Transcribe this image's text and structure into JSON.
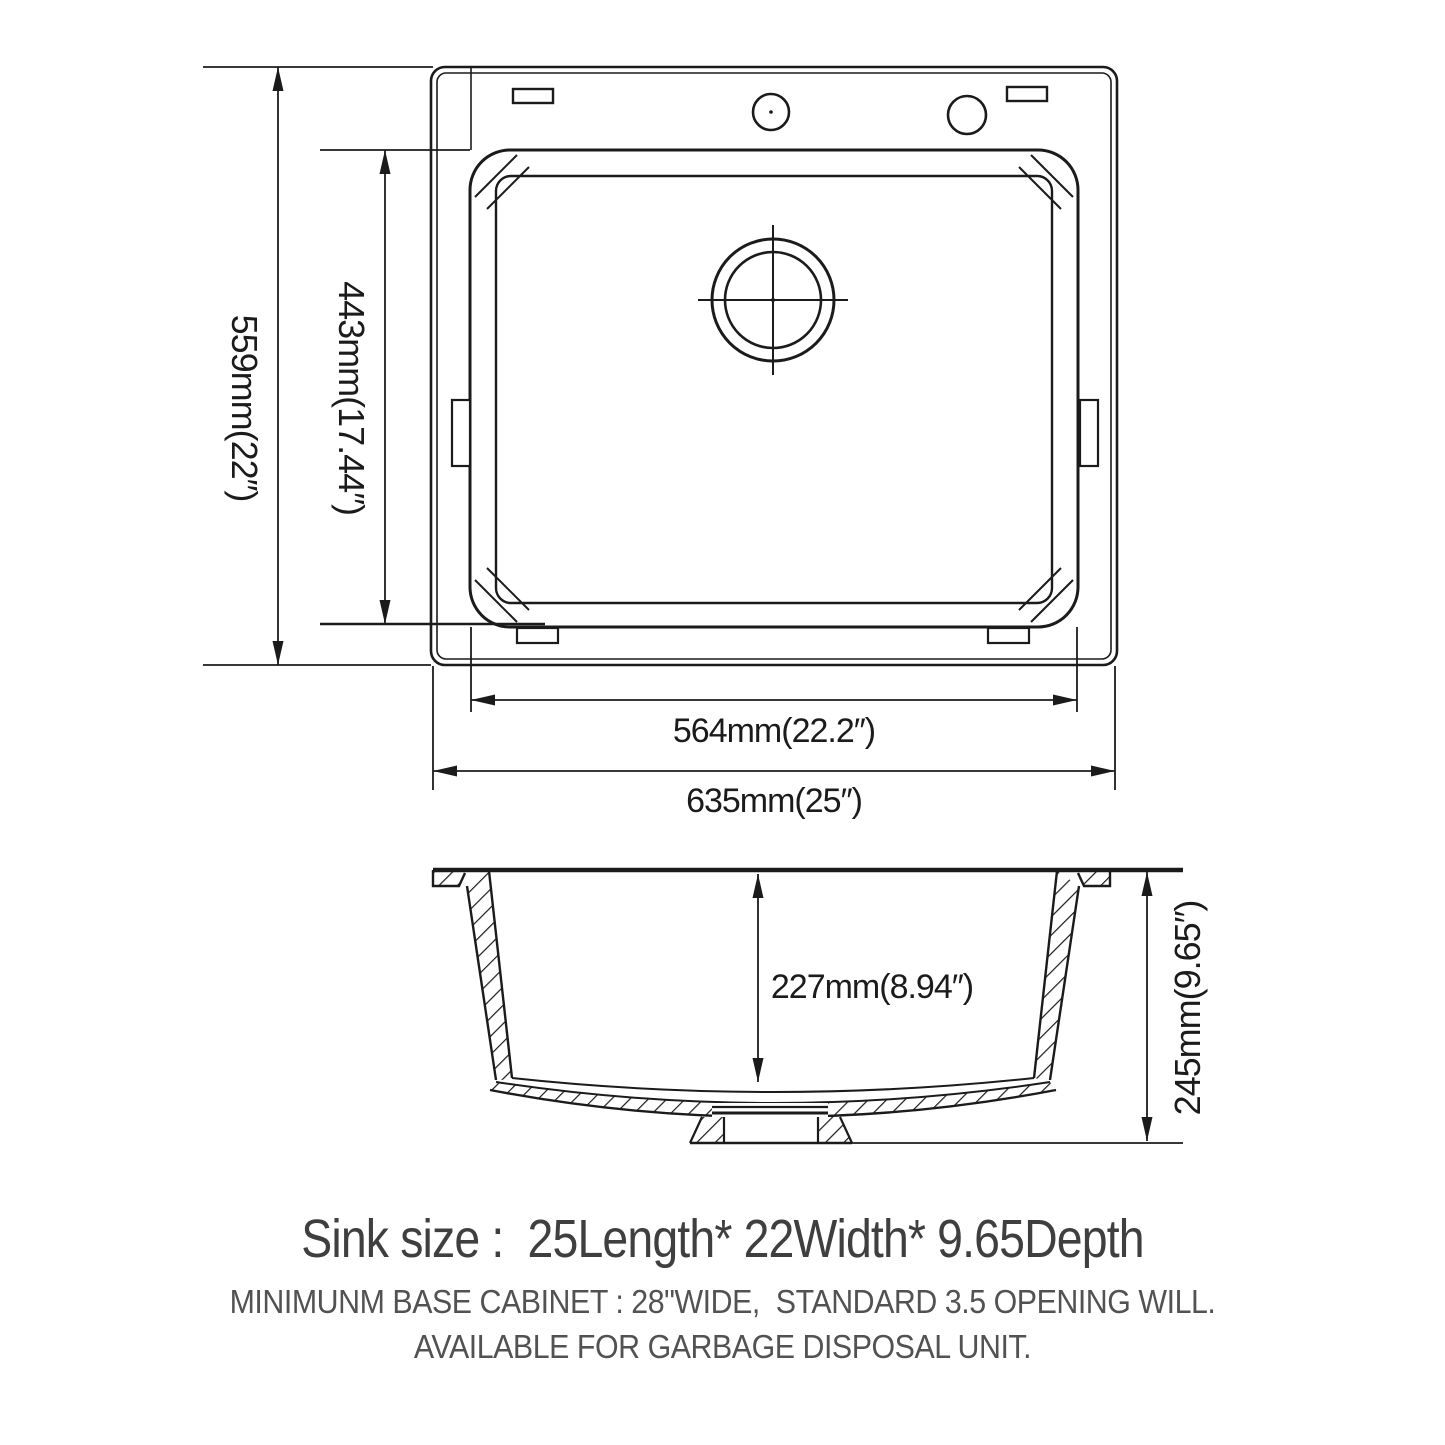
{
  "drawing": {
    "top_view": {
      "dim_overall_width_label": "559mm(22″)",
      "dim_bowl_width_label": "443mm(17.44″)",
      "dim_bowl_length_label": "564mm(22.2″)",
      "dim_overall_length_label": "635mm(25″)"
    },
    "side_view": {
      "dim_bowl_depth_label": "227mm(8.94″)",
      "dim_overall_depth_label": "245mm(9.65″)"
    }
  },
  "summary": {
    "heading": "Sink size :  25Length* 22Width* 9.65Depth",
    "note_line1": "MINIMUNM BASE CABINET : 28\"WIDE,  STANDARD 3.5 OPENING WILL.",
    "note_line2": "AVAILABLE FOR GARBAGE DISPOSAL UNIT."
  },
  "colors": {
    "line": "#1b1b1b",
    "heading_text": "#3f3f3f",
    "note_text": "#525252",
    "background": "#ffffff"
  }
}
